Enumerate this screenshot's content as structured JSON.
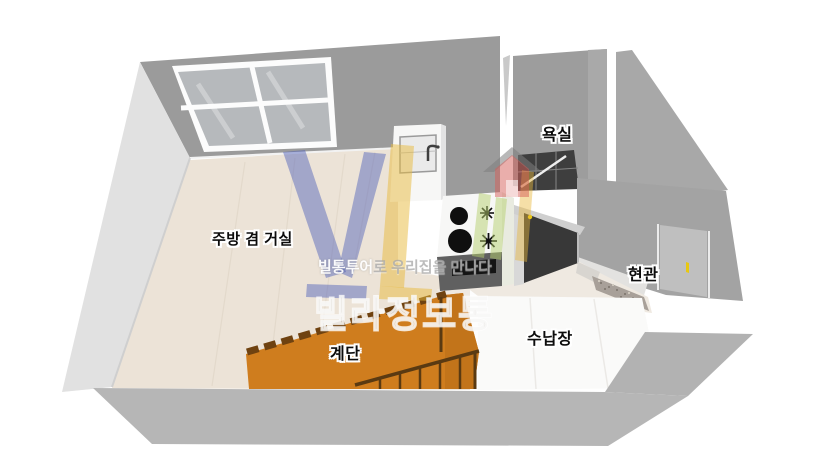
{
  "rooms": {
    "living_kitchen": "주방 겸 거실",
    "bathroom": "욕실",
    "entrance": "현관",
    "stairs": "계단",
    "storage": "수납장"
  },
  "watermark": {
    "tagline_head": "빌통투어",
    "tagline_tail": "로 우리집을 만나다",
    "brand": "빌라정보통"
  },
  "colors": {
    "background": "#ffffff",
    "back_wall": "#9b9b9b",
    "left_wall": "#e1e1e1",
    "floor_wood": "#ece3d7",
    "floor_hall": "#efe9e1",
    "window_pane": "#b6b9bc",
    "bathroom_wall": "#9d9d9d",
    "bathroom_tile": "#3e3e3e",
    "right_wall": "#a3a3a3",
    "door_dark": "#383838",
    "door_panel": "#bfbfbf",
    "door_handle": "#e8c812",
    "counter_white": "#f7f7f6",
    "stove_front": "#606060",
    "oven_black": "#141414",
    "burner_black": "#0f0f0f",
    "stairs_orange": "#cf7d1e",
    "stair_tread": "#6f4210",
    "railing_brown": "#5a3a12",
    "storage_floor": "#fafaf9",
    "front_wall_face": "#b6b6b6",
    "entrance_tile": "#a8a099",
    "logo_blue": "#4a5cb8",
    "logo_yellow": "#e8b93c",
    "logo_green": "#b5cf6e",
    "logo_red": "#d55d58"
  }
}
